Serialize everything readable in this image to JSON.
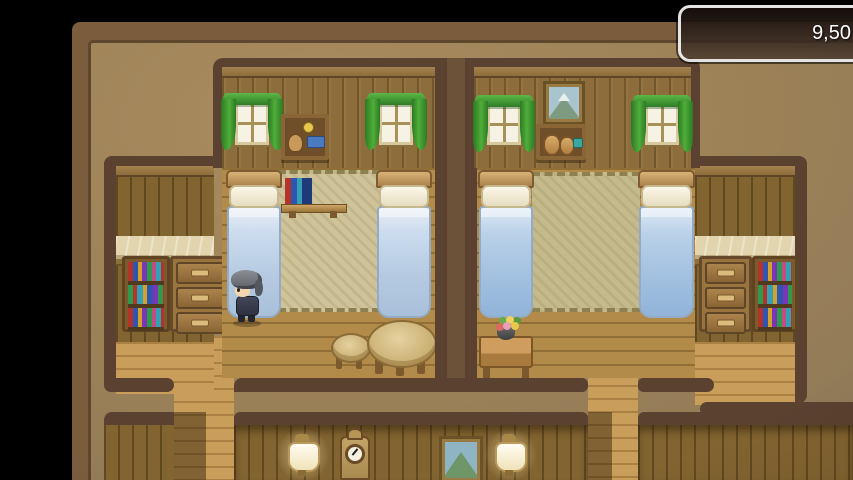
{
  "hud": {
    "gold": "9,50"
  },
  "scene_objects": {
    "player": "player-character",
    "furniture": [
      "bed",
      "wall-bookshelf",
      "bookshelf",
      "drawer-chest",
      "round-table",
      "stool",
      "flower-table",
      "grandfather-clock",
      "wall-lamp",
      "mountain-painting",
      "item-shelf",
      "pot-shelf",
      "window-with-curtains",
      "flower-vase"
    ]
  },
  "colors": {
    "background": "#000000",
    "frame_band": "#7b5d3e",
    "map_base": "#a0855b",
    "room_border": "#5a4130",
    "wall_planks": "#8d6d3b",
    "floor_planks": "#b28a49",
    "corridor_floor": "#c99e5a",
    "curtain_green": "#3f9c33",
    "bed_blanket_blue": "#b6cbe2",
    "mat_beige": "#cfc399",
    "hud_border": "#ffffff",
    "hud_background": "#2c201a",
    "hud_text": "#ffffff"
  }
}
